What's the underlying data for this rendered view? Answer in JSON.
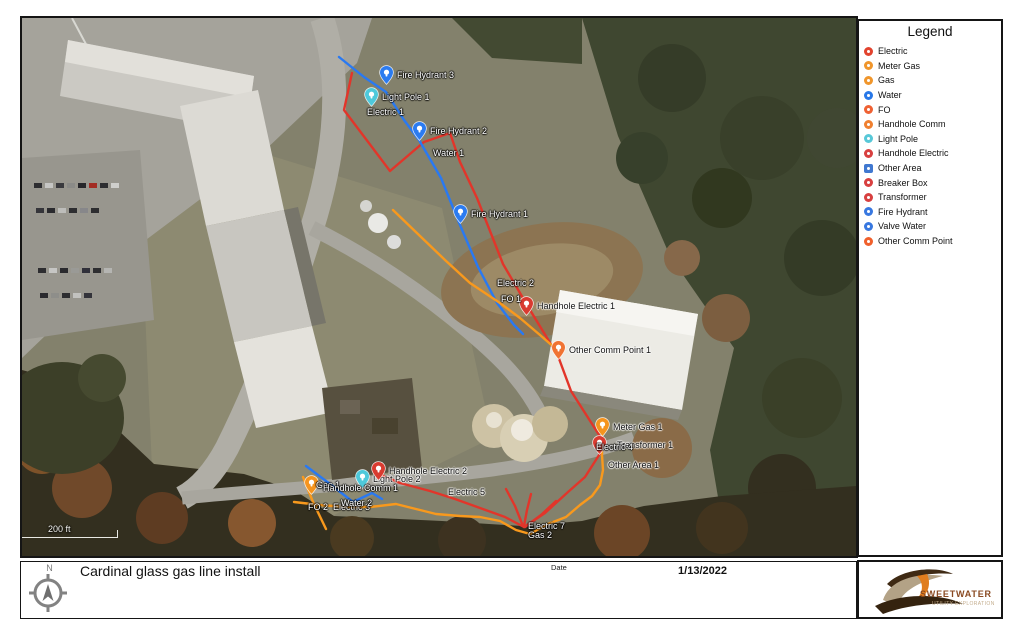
{
  "title_block": {
    "title": "Cardinal glass gas line install",
    "date_label": "Date",
    "date_value": "1/13/2022",
    "north_label": "N"
  },
  "logo": {
    "name": "SWEETWATER",
    "tagline": "UTILITY EXPLORATION",
    "brand_color": "#8a4a22"
  },
  "legend": {
    "title": "Legend",
    "items": [
      {
        "label": "Electric",
        "color": "#e2432e",
        "shape": "circle"
      },
      {
        "label": "Meter Gas",
        "color": "#f0962c",
        "shape": "circle"
      },
      {
        "label": "Gas",
        "color": "#f0962c",
        "shape": "circle"
      },
      {
        "label": "Water",
        "color": "#2878e8",
        "shape": "circle"
      },
      {
        "label": "FO",
        "color": "#ef6133",
        "shape": "circle"
      },
      {
        "label": "Handhole Comm",
        "color": "#f08030",
        "shape": "circle"
      },
      {
        "label": "Light Pole",
        "color": "#58c8d8",
        "shape": "circle"
      },
      {
        "label": "Handhole Electric",
        "color": "#d84040",
        "shape": "circle"
      },
      {
        "label": "Other Area",
        "color": "#4078d0",
        "shape": "square"
      },
      {
        "label": "Breaker Box",
        "color": "#d84040",
        "shape": "circle"
      },
      {
        "label": "Transformer",
        "color": "#d84040",
        "shape": "circle"
      },
      {
        "label": "Fire Hydrant",
        "color": "#3878e0",
        "shape": "circle"
      },
      {
        "label": "Valve Water",
        "color": "#3878e0",
        "shape": "circle"
      },
      {
        "label": "Other Comm Point",
        "color": "#f0602c",
        "shape": "circle"
      }
    ]
  },
  "map": {
    "scale_label": "200 ft",
    "line_colors": {
      "electric": "#e2352a",
      "water": "#2979f2",
      "gas_fo": "#f8991d"
    },
    "lines": [
      {
        "name": "electric-main",
        "color": "#e2352a",
        "points": [
          [
            330,
            55
          ],
          [
            322,
            92
          ],
          [
            368,
            153
          ],
          [
            402,
            124
          ],
          [
            428,
            115
          ],
          [
            438,
            144
          ],
          [
            455,
            180
          ],
          [
            481,
            246
          ],
          [
            505,
            287
          ],
          [
            536,
            338
          ],
          [
            549,
            373
          ],
          [
            579,
            420
          ]
        ]
      },
      {
        "name": "electric-branch",
        "color": "#e2352a",
        "points": [
          [
            579,
            434
          ],
          [
            563,
            459
          ],
          [
            546,
            474
          ],
          [
            523,
            495
          ],
          [
            502,
            509
          ]
        ]
      },
      {
        "name": "electric-5",
        "color": "#e2352a",
        "points": [
          [
            357,
            456
          ],
          [
            378,
            465
          ],
          [
            408,
            473
          ],
          [
            433,
            481
          ],
          [
            458,
            490
          ],
          [
            483,
            499
          ],
          [
            502,
            509
          ]
        ]
      },
      {
        "name": "electric-7a",
        "color": "#e2352a",
        "points": [
          [
            484,
            471
          ],
          [
            493,
            488
          ],
          [
            501,
            508
          ]
        ]
      },
      {
        "name": "electric-7b",
        "color": "#e2352a",
        "points": [
          [
            509,
            476
          ],
          [
            505,
            492
          ],
          [
            502,
            508
          ]
        ]
      },
      {
        "name": "electric-7c",
        "color": "#e2352a",
        "points": [
          [
            534,
            483
          ],
          [
            519,
            497
          ],
          [
            503,
            509
          ]
        ]
      },
      {
        "name": "water-main",
        "color": "#2979f2",
        "points": [
          [
            317,
            39
          ],
          [
            342,
            59
          ],
          [
            364,
            74
          ],
          [
            382,
            102
          ],
          [
            397,
            122
          ],
          [
            419,
            160
          ],
          [
            438,
            207
          ],
          [
            456,
            249
          ],
          [
            475,
            285
          ],
          [
            492,
            307
          ],
          [
            501,
            316
          ]
        ]
      },
      {
        "name": "water-2",
        "color": "#2979f2",
        "points": [
          [
            284,
            448
          ],
          [
            308,
            466
          ],
          [
            331,
            484
          ],
          [
            350,
            475
          ],
          [
            360,
            481
          ]
        ]
      },
      {
        "name": "fo-1",
        "color": "#f8991d",
        "points": [
          [
            371,
            192
          ],
          [
            398,
            218
          ],
          [
            423,
            242
          ],
          [
            448,
            265
          ],
          [
            478,
            285
          ],
          [
            498,
            300
          ],
          [
            518,
            317
          ],
          [
            534,
            331
          ]
        ]
      },
      {
        "name": "fo-2",
        "color": "#f8991d",
        "points": [
          [
            281,
            459
          ],
          [
            291,
            484
          ],
          [
            304,
            511
          ]
        ]
      },
      {
        "name": "gas-main",
        "color": "#f8991d",
        "points": [
          [
            272,
            484
          ],
          [
            298,
            487
          ],
          [
            323,
            489
          ],
          [
            348,
            489
          ],
          [
            374,
            486
          ],
          [
            398,
            492
          ],
          [
            414,
            496
          ],
          [
            438,
            498
          ],
          [
            458,
            499
          ],
          [
            478,
            503
          ],
          [
            494,
            512
          ],
          [
            508,
            516
          ],
          [
            526,
            506
          ],
          [
            544,
            499
          ],
          [
            558,
            487
          ],
          [
            570,
            478
          ],
          [
            578,
            467
          ],
          [
            581,
            452
          ],
          [
            580,
            437
          ],
          [
            580,
            422
          ]
        ]
      }
    ],
    "pins": [
      {
        "id": "fire-hydrant-3",
        "label": "Fire Hydrant 3",
        "x": 364,
        "y": 57,
        "color": "#2b7bf0",
        "label_color": "#ffffff"
      },
      {
        "id": "light-pole-1",
        "label": "Light Pole 1",
        "x": 349,
        "y": 79,
        "color": "#4ec9db",
        "label_color": "#ffffff"
      },
      {
        "id": "fire-hydrant-2",
        "label": "Fire Hydrant 2",
        "x": 397,
        "y": 113,
        "color": "#2b7bf0",
        "label_color": "#ffffff"
      },
      {
        "id": "fire-hydrant-1",
        "label": "Fire Hydrant 1",
        "x": 438,
        "y": 196,
        "color": "#2b7bf0",
        "label_color": "#ffffff"
      },
      {
        "id": "handhole-electric-1",
        "label": "Handhole Electric 1",
        "x": 504,
        "y": 288,
        "color": "#d93b30",
        "label_color": "#111111"
      },
      {
        "id": "other-comm-point-1",
        "label": "Other Comm Point 1",
        "x": 536,
        "y": 332,
        "color": "#f07333",
        "label_color": "#111111"
      },
      {
        "id": "transformer-1",
        "label": "Transformer 1",
        "x": 577,
        "y": 427,
        "color": "#d93b30",
        "label_color": "#111111",
        "label_dx": 18
      },
      {
        "id": "meter-gas-1",
        "label": "Meter Gas 1",
        "x": 580,
        "y": 409,
        "color": "#f5941e",
        "label_color": "#111111"
      },
      {
        "id": "gas-1",
        "label": "Gas 1",
        "x": 289,
        "y": 467,
        "color": "#f5941e",
        "label_color": "#ffffff",
        "label_dx": 5
      },
      {
        "id": "light-pole-2",
        "label": "Light Pole 2",
        "x": 340,
        "y": 461,
        "color": "#4ec9db",
        "label_color": "#111111"
      },
      {
        "id": "handhole-electric-2",
        "label": "Handhole Electric 2",
        "x": 356,
        "y": 453,
        "color": "#d93b30",
        "label_color": "#111111"
      }
    ],
    "labels": [
      {
        "id": "electric-1",
        "text": "Electric 1",
        "x": 345,
        "y": 94,
        "color": "#ffffff"
      },
      {
        "id": "water-1",
        "text": "Water 1",
        "x": 411,
        "y": 135,
        "color": "#ffffff"
      },
      {
        "id": "electric-2",
        "text": "Electric 2",
        "x": 475,
        "y": 265,
        "color": "#ffffff"
      },
      {
        "id": "fo-1",
        "text": "FO 1",
        "x": 479,
        "y": 281,
        "color": "#ffffff"
      },
      {
        "id": "electric-4",
        "text": "Electric 4",
        "x": 574,
        "y": 429,
        "color": "#ffffff"
      },
      {
        "id": "other-area-1",
        "text": "Other Area 1",
        "x": 586,
        "y": 447,
        "color": "#111111"
      },
      {
        "id": "handhole-comm-1",
        "text": "Handhole Comm 1",
        "x": 301,
        "y": 470,
        "color": "#ffffff"
      },
      {
        "id": "fo-2",
        "text": "FO 2",
        "x": 286,
        "y": 489,
        "color": "#ffffff"
      },
      {
        "id": "electric-3",
        "text": "Electric 3",
        "x": 311,
        "y": 489,
        "color": "#ffffff"
      },
      {
        "id": "water-2",
        "text": "Water 2",
        "x": 319,
        "y": 485,
        "color": "#ffffff"
      },
      {
        "id": "electric-5",
        "text": "Electric 5",
        "x": 426,
        "y": 474,
        "color": "#111111"
      },
      {
        "id": "electric-7",
        "text": "Electric 7",
        "x": 506,
        "y": 508,
        "color": "#ffffff"
      },
      {
        "id": "gas-2",
        "text": "Gas 2",
        "x": 506,
        "y": 517,
        "color": "#ffffff"
      }
    ]
  }
}
